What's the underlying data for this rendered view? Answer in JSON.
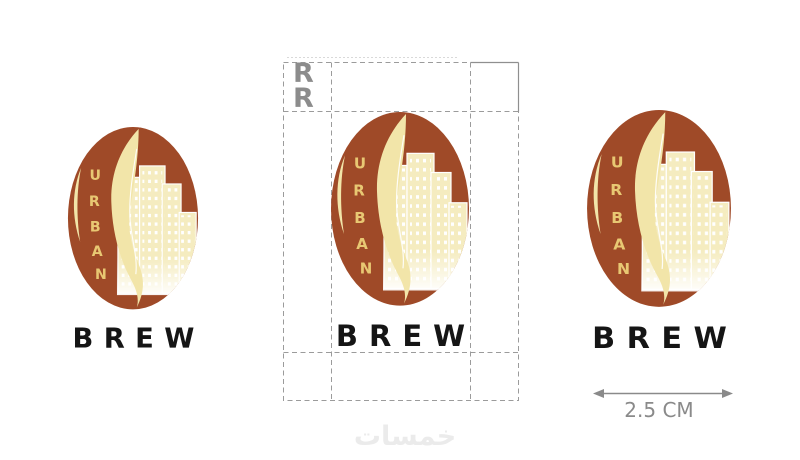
{
  "brand": {
    "name_vertical": "URBAN",
    "urban_letters": [
      "U",
      "R",
      "B",
      "A",
      "N"
    ],
    "brew": "BREW"
  },
  "clearspace": {
    "marker_letters": [
      "R",
      "R"
    ]
  },
  "measurement": {
    "width_label": "2.5 CM"
  },
  "watermark": {
    "text": "خمسات"
  },
  "colors": {
    "bean_brown": "#9F4A28",
    "swoosh_cream": "#F2E5A9",
    "building_cream": "#F5ECC0",
    "window_white": "#FFFFFF",
    "letter_gold": "#E8C873",
    "brew_black": "#151515",
    "guide_gray": "#9B9B9B",
    "guide_faint_gray": "#D9D9D9",
    "corner_solid_gray": "#8F8F8F",
    "marker_gray": "#8C8C8C",
    "measure_gray": "#8A8A8A",
    "watermark_gray": "#EBEBEB"
  }
}
